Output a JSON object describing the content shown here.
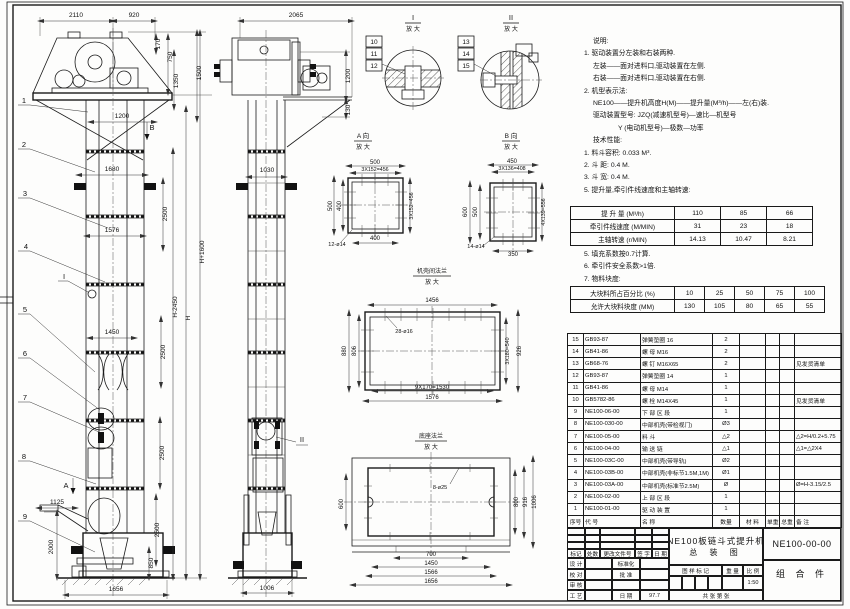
{
  "sheet_title": {
    "product": "NE100板链斗式提升机",
    "drawing_type": "总  装  图",
    "drawing_no": "NE100-00-00",
    "part_class": "组 合 件",
    "scale": "1:50",
    "date": "97.7",
    "sheets": "共    张    第    张"
  },
  "titleblock_labels": {
    "mark": "标记",
    "count": "处数",
    "change_doc": "更改文件号",
    "sign": "签 字",
    "date": "日 期",
    "design": "设 计",
    "standardize": "标准化",
    "check": "校 对",
    "approve": "批 准",
    "review": "审 核",
    "process": "工 艺",
    "date2": "日 期",
    "stamp": "图 样 标 记",
    "weight": "重 量",
    "scale_lbl": "比 例"
  },
  "notes": {
    "lines": [
      {
        "t": "说明:",
        "i": 2
      },
      {
        "t": "1. 驱动装置分左装和右装两种.",
        "i": 1
      },
      {
        "t": "左装——面对进料口,驱动装置在左侧.",
        "i": 2
      },
      {
        "t": "右装——面对进料口,驱动装置在右侧.",
        "i": 2
      },
      {
        "t": "2. 机型表示法:",
        "i": 1
      },
      {
        "t": "NE100——提升机高度H(M)——提升量(M³/h)——左(右)装.",
        "i": 2
      },
      {
        "t": "驱动装置型号: JZQ(减速机型号)—速比—机型号",
        "i": 2
      },
      {
        "t": "Y (电动机型号)—极数—功率",
        "i": 3
      },
      {
        "t": "技术性能:",
        "i": 2
      },
      {
        "t": "1. 料斗容积: 0.033 M³.",
        "i": 1
      },
      {
        "t": "2. 斗  距: 0.4 M.",
        "i": 1
      },
      {
        "t": "3. 斗  宽: 0.4 M.",
        "i": 1
      },
      {
        "t": "5. 提升量,牵引件线速度和主轴转速:",
        "i": 1
      }
    ]
  },
  "notes2": {
    "lines": [
      {
        "t": "5. 填充系数按0.7计算.",
        "i": 1
      },
      {
        "t": "6. 牵引件安全系数>1倍.",
        "i": 1
      },
      {
        "t": "7. 物料块度:",
        "i": 1
      }
    ]
  },
  "spec1": {
    "rows": [
      [
        "提 升 量 (M³/h)",
        "110",
        "85",
        "66"
      ],
      [
        "牵引件线速度 (M/MIN)",
        "31",
        "23",
        "18"
      ],
      [
        "主轴转速 (r/MIN)",
        "14.13",
        "10.47",
        "8.21"
      ]
    ]
  },
  "spec2": {
    "rows": [
      [
        "大块料所占百分比 (%)",
        "10",
        "25",
        "50",
        "75",
        "100"
      ],
      [
        "允许大块料块度 (MM)",
        "130",
        "105",
        "80",
        "65",
        "55"
      ]
    ]
  },
  "bom": {
    "header": [
      "序号",
      "代  号",
      "名  称",
      "数量",
      "材  料",
      "单重",
      "总重",
      "备  注"
    ],
    "rows": [
      [
        "15",
        "GB93-87",
        "弹簧垫圈  16",
        "2",
        "",
        "",
        "",
        ""
      ],
      [
        "14",
        "GB41-86",
        "螺  母  M16",
        "2",
        "",
        "",
        "",
        ""
      ],
      [
        "13",
        "GB68-76",
        "螺  钉  M16X65",
        "2",
        "",
        "",
        "",
        "见发货清单"
      ],
      [
        "12",
        "GB93-87",
        "弹簧垫圈  14",
        "1",
        "",
        "",
        "",
        ""
      ],
      [
        "11",
        "GB41-86",
        "螺  母  M14",
        "1",
        "",
        "",
        "",
        ""
      ],
      [
        "10",
        "GB5782-86",
        "螺  栓  M14X45",
        "1",
        "",
        "",
        "",
        "见发货清单"
      ],
      [
        "9",
        "NE100-06-00",
        "下 部 区 段",
        "1",
        "",
        "",
        "",
        ""
      ],
      [
        "8",
        "NE100-030-00",
        "中部机壳(带检视门)",
        "Ø3",
        "",
        "",
        "",
        ""
      ],
      [
        "7",
        "NE100-05-00",
        "料  斗",
        "△2",
        "",
        "",
        "",
        "△2=H/0.2+5.75"
      ],
      [
        "6",
        "NE100-04-00",
        "输 送 链",
        "△1",
        "",
        "",
        "",
        "△1=△2X4"
      ],
      [
        "5",
        "NE100-03C-00",
        "中部机壳(带导轨)",
        "Ø2",
        "",
        "",
        "",
        ""
      ],
      [
        "4",
        "NE100-03B-00",
        "中部机壳(非标节1.5M,1M)",
        "Ø1",
        "",
        "",
        "",
        ""
      ],
      [
        "3",
        "NE100-03A-00",
        "中部机壳(标准节2.5M)",
        "Ø",
        "",
        "",
        "",
        "Ø=H-3.15/2.5"
      ],
      [
        "2",
        "NE100-02-00",
        "上 部 区 段",
        "1",
        "",
        "",
        "",
        ""
      ],
      [
        "1",
        "NE100-01-00",
        "驱 动 装 置",
        "1",
        "",
        "",
        "",
        ""
      ]
    ]
  },
  "drawing_labels": [
    {
      "x": 76,
      "y": 17,
      "t": "2110"
    },
    {
      "x": 134,
      "y": 17,
      "t": "920"
    },
    {
      "x": 160,
      "y": 44,
      "t": "170",
      "r": -90
    },
    {
      "x": 172,
      "y": 57,
      "t": "750",
      "r": -90
    },
    {
      "x": 178,
      "y": 81,
      "t": "1350",
      "r": -90
    },
    {
      "x": 201,
      "y": 73,
      "t": "1500",
      "r": -90
    },
    {
      "x": 122,
      "y": 118,
      "t": "1200"
    },
    {
      "x": 152,
      "y": 130,
      "t": "B",
      "s": 7.5
    },
    {
      "x": 112,
      "y": 171,
      "t": "1680"
    },
    {
      "x": 167,
      "y": 214,
      "t": "2500",
      "r": -90
    },
    {
      "x": 112,
      "y": 232,
      "t": "1576"
    },
    {
      "x": 204,
      "y": 252,
      "t": "H+1600",
      "r": -90
    },
    {
      "x": 177,
      "y": 307,
      "t": "H-2450",
      "r": -90
    },
    {
      "x": 190,
      "y": 318,
      "t": "H",
      "r": -90
    },
    {
      "x": 112,
      "y": 334,
      "t": "1450"
    },
    {
      "x": 165,
      "y": 352,
      "t": "2500",
      "r": -90
    },
    {
      "x": 164,
      "y": 453,
      "t": "2500",
      "r": -90
    },
    {
      "x": 159,
      "y": 530,
      "t": "2500",
      "r": -90
    },
    {
      "x": 153,
      "y": 563,
      "t": "850",
      "r": -90
    },
    {
      "x": 53,
      "y": 547,
      "t": "2000",
      "r": -90
    },
    {
      "x": 57,
      "y": 504,
      "t": "1125"
    },
    {
      "x": 116,
      "y": 591,
      "t": "1656"
    },
    {
      "x": 66,
      "y": 488,
      "t": "A",
      "s": 7.5
    },
    {
      "x": 64,
      "y": 279,
      "t": "I",
      "s": 7.5
    },
    {
      "x": 24,
      "y": 103,
      "t": "1",
      "s": 7.5
    },
    {
      "x": 24,
      "y": 147,
      "t": "2",
      "s": 7.5
    },
    {
      "x": 25,
      "y": 196,
      "t": "3",
      "s": 7.5
    },
    {
      "x": 26,
      "y": 249,
      "t": "4",
      "s": 7.5
    },
    {
      "x": 25,
      "y": 312,
      "t": "5",
      "s": 7.5
    },
    {
      "x": 25,
      "y": 356,
      "t": "6",
      "s": 7.5
    },
    {
      "x": 25,
      "y": 400,
      "t": "7",
      "s": 7.5
    },
    {
      "x": 24,
      "y": 459,
      "t": "8",
      "s": 7.5
    },
    {
      "x": 25,
      "y": 519,
      "t": "9",
      "s": 7.5
    },
    {
      "x": 296,
      "y": 17,
      "t": "2065"
    },
    {
      "x": 350,
      "y": 76,
      "t": "1200",
      "r": -90
    },
    {
      "x": 350,
      "y": 110,
      "t": "130",
      "r": -90
    },
    {
      "x": 267,
      "y": 172,
      "t": "1030"
    },
    {
      "x": 267,
      "y": 590,
      "t": "1006"
    },
    {
      "x": 302,
      "y": 442,
      "t": "II",
      "s": 7.5
    },
    {
      "x": 413,
      "y": 20,
      "t": "I",
      "s": 7.5
    },
    {
      "x": 413,
      "y": 31,
      "t": "放 大",
      "s": 6
    },
    {
      "x": 374,
      "y": 44,
      "t": "10"
    },
    {
      "x": 374,
      "y": 56,
      "t": "11"
    },
    {
      "x": 374,
      "y": 68,
      "t": "12"
    },
    {
      "x": 511,
      "y": 20,
      "t": "II",
      "s": 7.5
    },
    {
      "x": 511,
      "y": 31,
      "t": "放 大",
      "s": 6
    },
    {
      "x": 466,
      "y": 44,
      "t": "13"
    },
    {
      "x": 466,
      "y": 56,
      "t": "14"
    },
    {
      "x": 466,
      "y": 68,
      "t": "15"
    },
    {
      "x": 363,
      "y": 138,
      "t": "A 向",
      "s": 6.5
    },
    {
      "x": 363,
      "y": 149,
      "t": "放 大",
      "s": 6
    },
    {
      "x": 375,
      "y": 164,
      "t": "500",
      "s": 6
    },
    {
      "x": 375,
      "y": 171,
      "t": "3X152=456",
      "s": 5.3
    },
    {
      "x": 332,
      "y": 206,
      "t": "500",
      "r": -90,
      "s": 6
    },
    {
      "x": 341,
      "y": 206,
      "t": "400",
      "r": -90,
      "s": 6
    },
    {
      "x": 413,
      "y": 206,
      "t": "3X152=456",
      "r": -90,
      "s": 5.3
    },
    {
      "x": 375,
      "y": 240,
      "t": "400",
      "s": 6
    },
    {
      "x": 337,
      "y": 246,
      "t": "12-ø14",
      "s": 5.5
    },
    {
      "x": 511,
      "y": 138,
      "t": "B 向",
      "s": 6.5
    },
    {
      "x": 511,
      "y": 149,
      "t": "放 大",
      "s": 6
    },
    {
      "x": 512,
      "y": 163,
      "t": "450",
      "s": 6
    },
    {
      "x": 512,
      "y": 170,
      "t": "3X136=408",
      "s": 5.3
    },
    {
      "x": 467,
      "y": 212,
      "t": "600",
      "r": -90,
      "s": 6
    },
    {
      "x": 477,
      "y": 212,
      "t": "500",
      "r": -90,
      "s": 6
    },
    {
      "x": 545,
      "y": 212,
      "t": "4X139=556",
      "r": -90,
      "s": 5.3
    },
    {
      "x": 513,
      "y": 256,
      "t": "350",
      "s": 6
    },
    {
      "x": 476,
      "y": 248,
      "t": "14-ø14",
      "s": 5.5
    },
    {
      "x": 432,
      "y": 273,
      "t": "机壳间法兰",
      "s": 6
    },
    {
      "x": 432,
      "y": 284,
      "t": "放 大",
      "s": 6
    },
    {
      "x": 432,
      "y": 302,
      "t": "1456",
      "s": 6
    },
    {
      "x": 346,
      "y": 351,
      "t": "880",
      "r": -90,
      "s": 6
    },
    {
      "x": 356,
      "y": 351,
      "t": "806",
      "r": -90,
      "s": 6
    },
    {
      "x": 509,
      "y": 351,
      "t": "3X180=540",
      "r": -90,
      "s": 5.3
    },
    {
      "x": 521,
      "y": 351,
      "t": "926",
      "r": -90,
      "s": 6
    },
    {
      "x": 432,
      "y": 389,
      "t": "9X170=1530",
      "s": 6
    },
    {
      "x": 432,
      "y": 399,
      "t": "1576",
      "s": 6
    },
    {
      "x": 404,
      "y": 333,
      "t": "28-ø16",
      "s": 5.5
    },
    {
      "x": 431,
      "y": 438,
      "t": "底座法兰",
      "s": 6
    },
    {
      "x": 431,
      "y": 449,
      "t": "放 大",
      "s": 6
    },
    {
      "x": 440,
      "y": 489,
      "t": "8-ø25",
      "s": 5.5
    },
    {
      "x": 343,
      "y": 504,
      "t": "600",
      "r": -90,
      "s": 6
    },
    {
      "x": 518,
      "y": 502,
      "t": "800",
      "r": -90,
      "s": 6
    },
    {
      "x": 527,
      "y": 502,
      "t": "916",
      "r": -90,
      "s": 6
    },
    {
      "x": 536,
      "y": 502,
      "t": "1006",
      "r": -90,
      "s": 6
    },
    {
      "x": 431,
      "y": 556,
      "t": "700",
      "s": 6
    },
    {
      "x": 431,
      "y": 565,
      "t": "1450",
      "s": 6
    },
    {
      "x": 431,
      "y": 574,
      "t": "1566",
      "s": 6
    },
    {
      "x": 431,
      "y": 583,
      "t": "1656",
      "s": 6
    }
  ]
}
